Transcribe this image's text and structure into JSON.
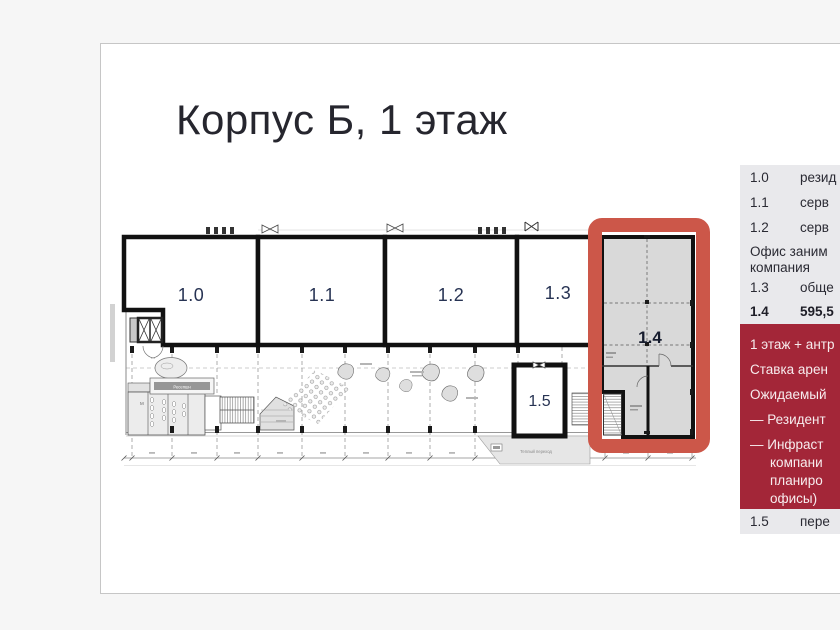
{
  "page": {
    "title": "Корпус Б, 1 этаж"
  },
  "colors": {
    "highlight_box_red": "#cc5749",
    "sidebar_red": "#a32638",
    "row_gray": "#e9e9ec",
    "room_label_navy": "#273353",
    "card_bg": "#ffffff",
    "page_bg": "#f6f6f6"
  },
  "plan": {
    "labels": {
      "r10": "1.0",
      "r11": "1.1",
      "r12": "1.2",
      "r13": "1.3",
      "r14": "1.4",
      "r15": "1.5"
    },
    "texts": {
      "reception": "Ресепшн",
      "walkway": "Теплый переход"
    }
  },
  "sidebar": {
    "rows": [
      {
        "num": "1.0",
        "text": "резид"
      },
      {
        "num": "1.1",
        "text": "серв"
      },
      {
        "num": "1.2",
        "text": "серв"
      },
      {
        "num": "1.3",
        "text": "обще"
      },
      {
        "num": "1.4",
        "text": "595,5"
      },
      {
        "num": "1.5",
        "text": "пере"
      }
    ],
    "note": {
      "line1": "Офис заним",
      "line2": "компания"
    },
    "highlight": {
      "lines": [
        "1 этаж + антр",
        "Ставка арен",
        "Ожидаемый",
        "— Резидент",
        "— Инфраст",
        "компани",
        "планиро",
        "офисы)"
      ]
    }
  }
}
